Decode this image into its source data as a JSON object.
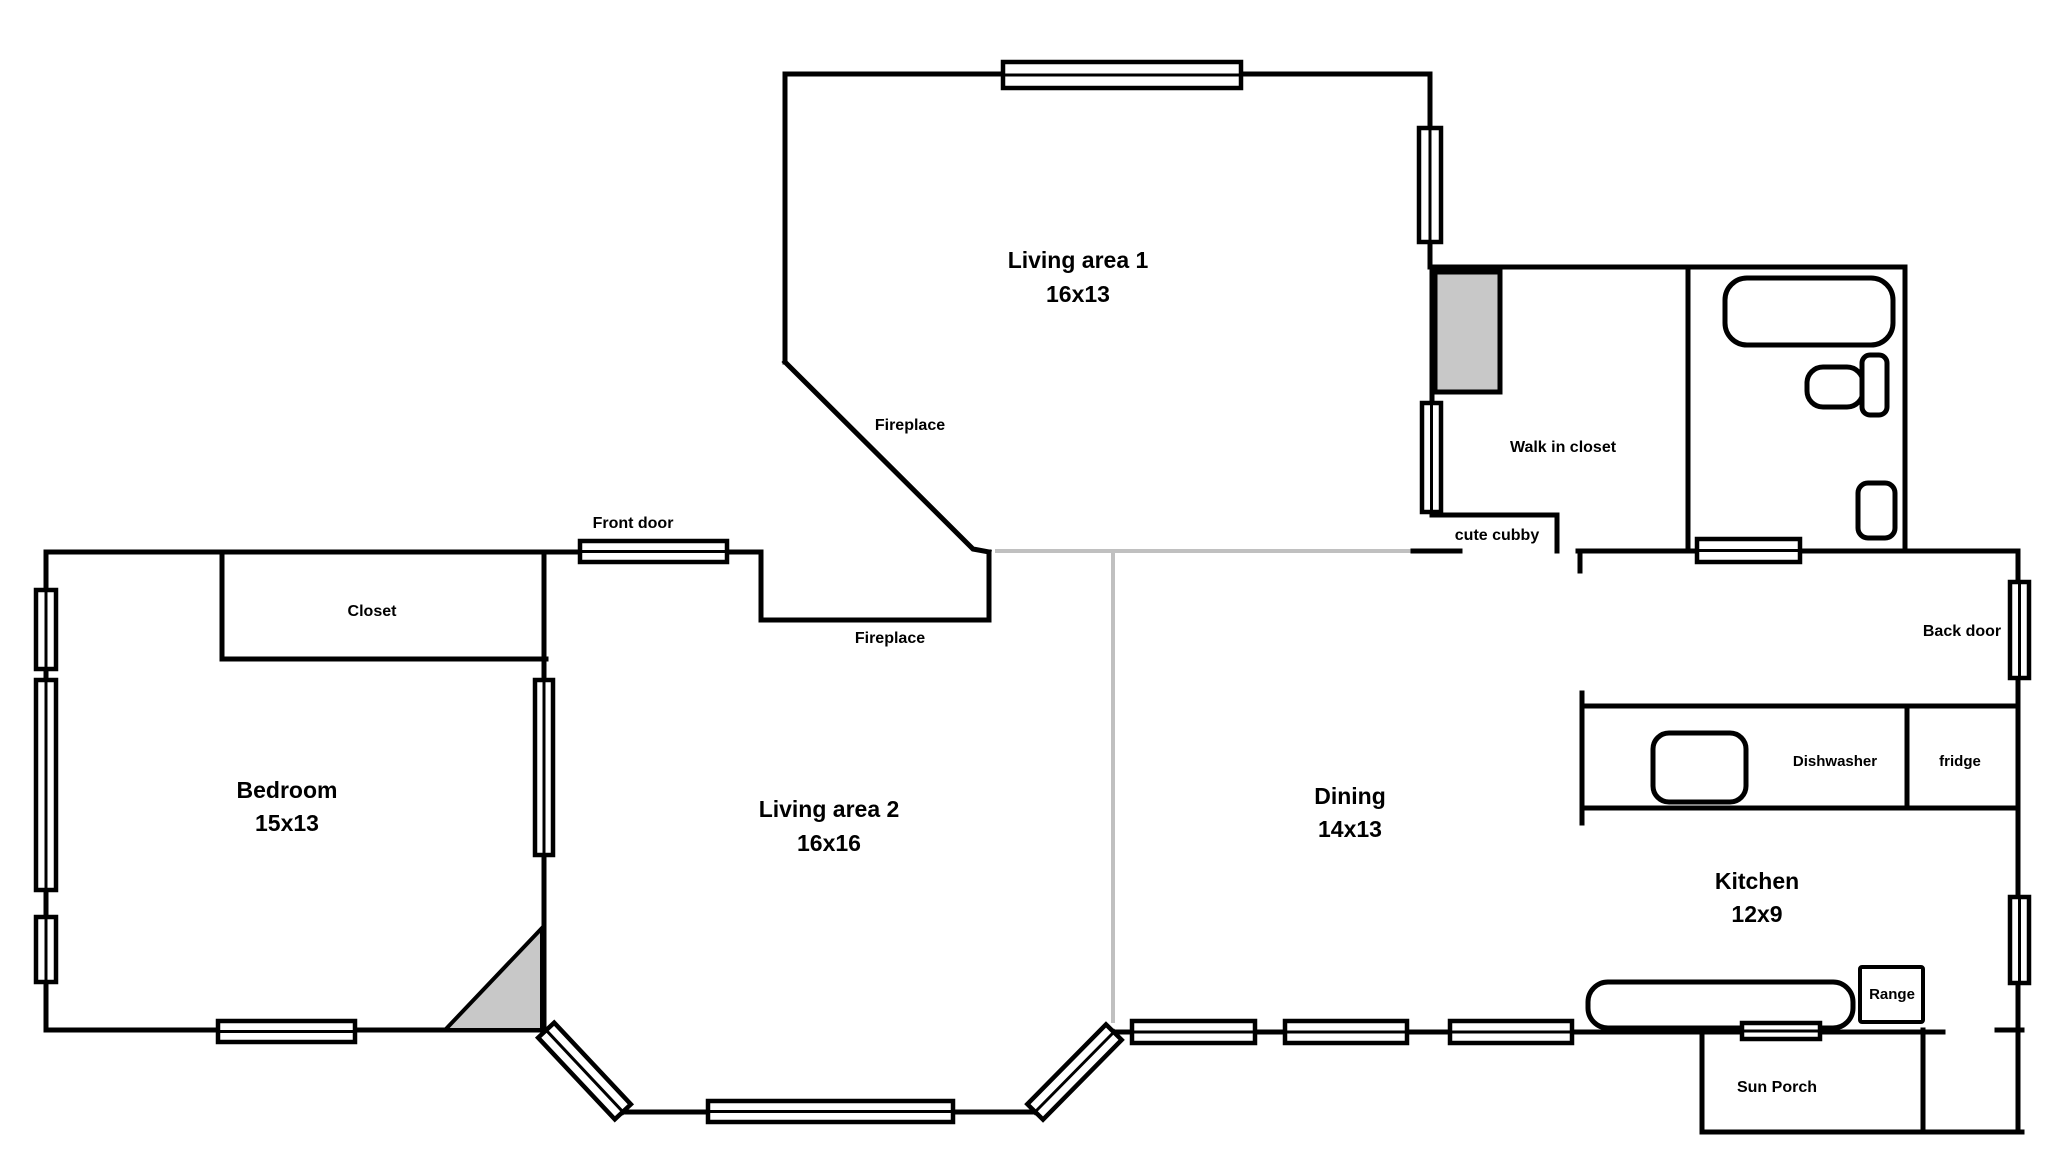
{
  "title": "House floor plan sketch",
  "colors": {
    "wall": "#000000",
    "open_divider": "#c0c0c0",
    "shaded_fill": "#c8c8c8",
    "background": "#ffffff"
  },
  "rooms": {
    "living1": {
      "name": "Living area 1",
      "dims": "16x13"
    },
    "living2": {
      "name": "Living area 2",
      "dims": "16x16"
    },
    "bedroom": {
      "name": "Bedroom",
      "dims": "15x13"
    },
    "dining": {
      "name": "Dining",
      "dims": "14x13"
    },
    "kitchen": {
      "name": "Kitchen",
      "dims": "12x9"
    },
    "sun_porch": {
      "name": "Sun Porch"
    },
    "walk_in_closet": {
      "name": "Walk in closet"
    },
    "closet": {
      "name": "Closet"
    },
    "cute_cubby": {
      "name": "cute cubby"
    }
  },
  "features": {
    "fireplace1": "Fireplace",
    "fireplace2": "Fireplace",
    "front_door": "Front door",
    "back_door": "Back door"
  },
  "fixtures": {
    "dishwasher": "Dishwasher",
    "fridge": "fridge",
    "range": "Range"
  }
}
